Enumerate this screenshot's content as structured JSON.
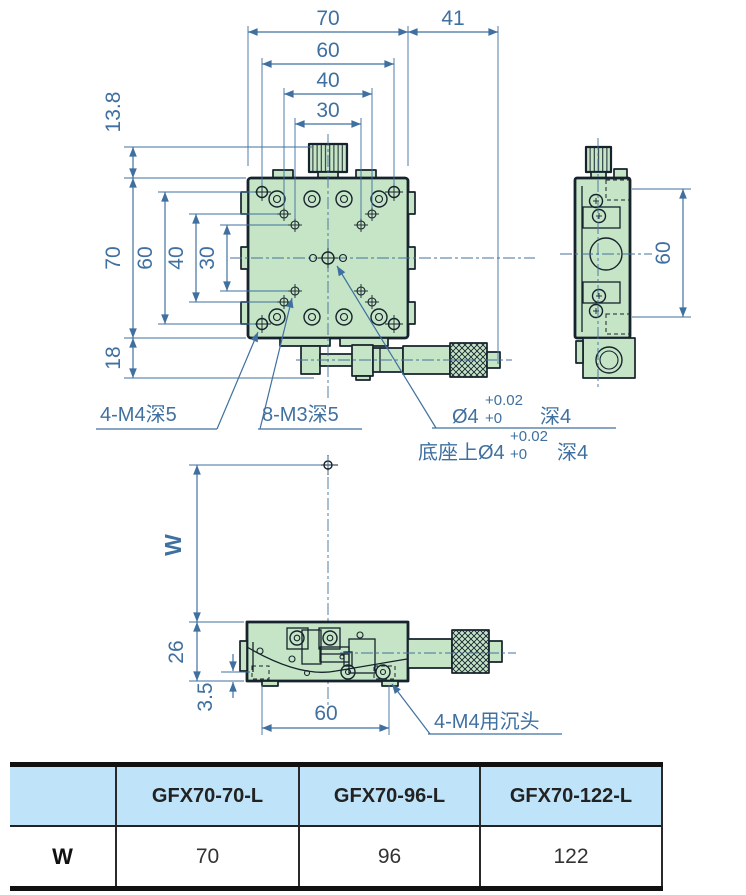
{
  "drawing": {
    "top": {
      "d70": "70",
      "d41": "41",
      "d60": "60",
      "d40": "40",
      "d30": "30"
    },
    "left": {
      "d138": "13.8",
      "d70": "70",
      "d60": "60",
      "d40": "40",
      "d30": "30",
      "d18": "18"
    },
    "side": {
      "d60": "60"
    },
    "bottom": {
      "dW": "W",
      "d26": "26",
      "d35": "3.5",
      "d60": "60"
    },
    "notes": {
      "m4": "4-M4深5",
      "m3": "8-M3深5",
      "dia": "Ø4",
      "tol_up": "+0.02",
      "tol_low": "+0",
      "depth": "深4",
      "base": "底座上Ø4",
      "base_tol_up": "+0.02",
      "base_tol_low": "+0",
      "base_depth": "深4",
      "m4_sink": "4-M4用沉头"
    }
  },
  "table": {
    "corner_label": "",
    "row_label": "W",
    "columns": [
      "GFX70-70-L",
      "GFX70-96-L",
      "GFX70-122-L"
    ],
    "values": [
      "70",
      "96",
      "122"
    ]
  },
  "colors": {
    "stage_green": "#c5e5c6",
    "outline_dark": "#16222c",
    "dimension_blue": "#3f70a0",
    "table_header_bg": "#bfe3f8"
  }
}
